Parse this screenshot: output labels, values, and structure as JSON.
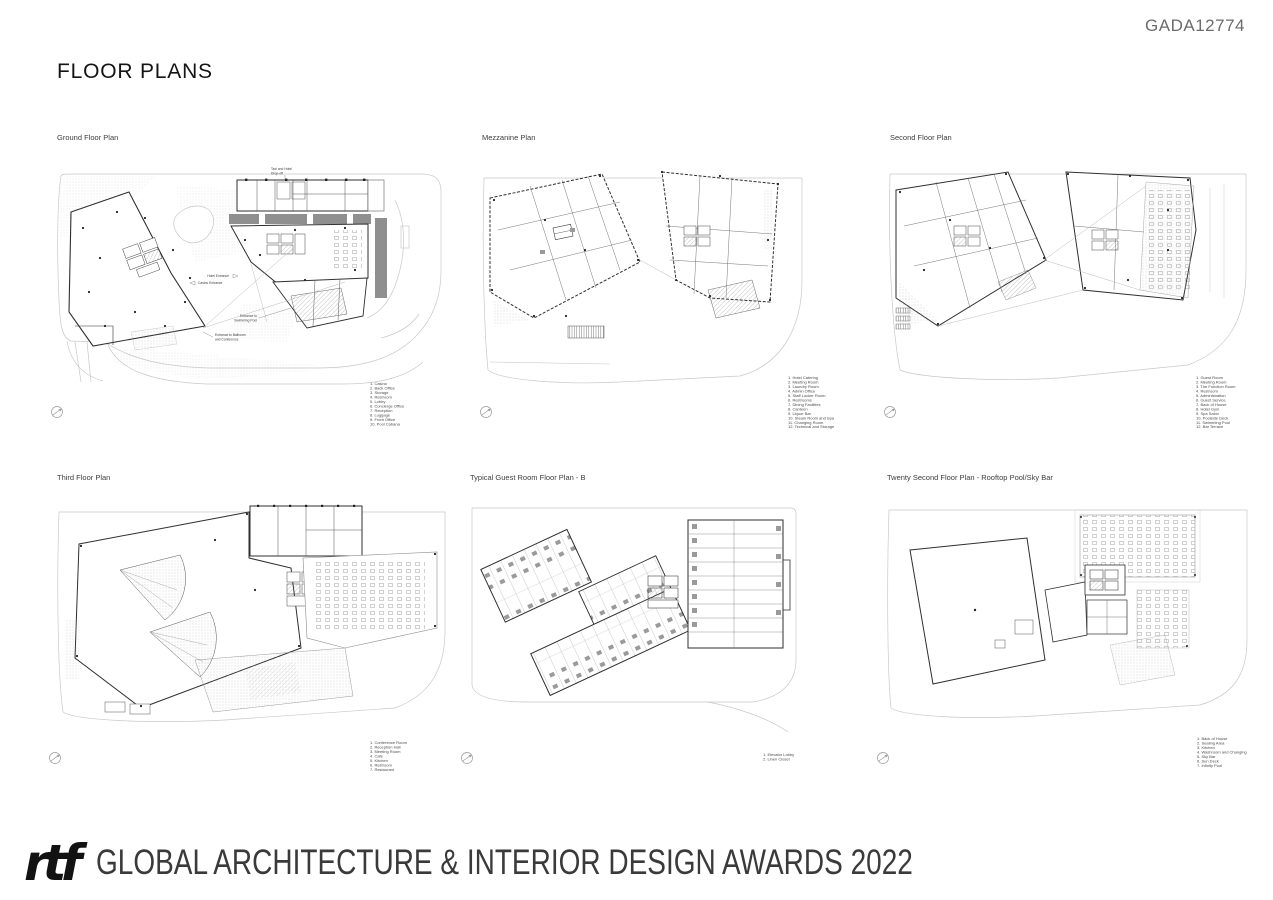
{
  "page": {
    "code": "GADA12774",
    "title": "FLOOR PLANS"
  },
  "colors": {
    "paper": "#ffffff",
    "plan_line": "#2f2f2f",
    "site_line": "#c8c8c8",
    "gray_fill": "#8f8f8f",
    "code_text": "#6c6c6c"
  },
  "icons": {
    "north_arrow": "north-arrow-icon"
  },
  "plans": [
    {
      "title": "Ground Floor Plan",
      "annotations": {
        "drop_off_1": "Taxi and Hotel",
        "drop_off_2": "Drop-off",
        "hotel_entrance": "Hotel Entrance",
        "casino_entrance": "Casino Entrance",
        "pool_1": "Entrance to",
        "pool_2": "Swimming Pool",
        "ballroom_1": "Entrance to Ballroom",
        "ballroom_2": "and Conference"
      },
      "legend": [
        "1. Casino",
        "2. Back Office",
        "3. Storage",
        "4. Restroom",
        "5. Lobby",
        "6. Concierge Office",
        "7. Reception",
        "8. Luggage",
        "9. Front Office",
        "10. Pool Cabana"
      ]
    },
    {
      "title": "Mezzanine Plan",
      "legend": [
        "1. Hotel Catering",
        "2. Meeting Room",
        "3. Laundry Room",
        "4. Admin Office",
        "5. Staff Locker Room",
        "6. Restrooms",
        "7. Dining Facilities",
        "8. Canteen",
        "9. Liquor Bar",
        "10. Steam Room and Spa",
        "11. Changing Room",
        "12. Technical and Storage"
      ]
    },
    {
      "title": "Second Floor Plan",
      "legend": [
        "1. Guest Room",
        "2. Meeting Room",
        "3. The Function Room",
        "4. Restroom",
        "5. Administration",
        "6. Guest Service",
        "7. Back of House",
        "8. Hotel Gym",
        "9. Spa Salon",
        "10. Poolside Deck",
        "11. Swimming Pool",
        "12. Bar Terrace"
      ]
    },
    {
      "title": "Third Floor Plan",
      "legend": [
        "1. Conference Room",
        "2. Reception Hall",
        "3. Meeting Room",
        "4. Cafe",
        "5. Kitchen",
        "6. Restroom",
        "7. Restaurant"
      ]
    },
    {
      "title": "Typical Guest Room Floor Plan - B",
      "legend": [
        "1. Elevator Lobby",
        "2. Linen Closet"
      ]
    },
    {
      "title": "Twenty Second Floor Plan - Rooftop Pool/Sky Bar",
      "legend": [
        "1. Back of House",
        "2. Seating Area",
        "3. Kitchen",
        "4. Washroom and Changing",
        "5. Sky Bar",
        "6. Sun Deck",
        "7. Infinity Pool"
      ]
    }
  ],
  "footer": {
    "logo": "rtf",
    "text": "GLOBAL ARCHITECTURE & INTERIOR DESIGN AWARDS 2022"
  }
}
